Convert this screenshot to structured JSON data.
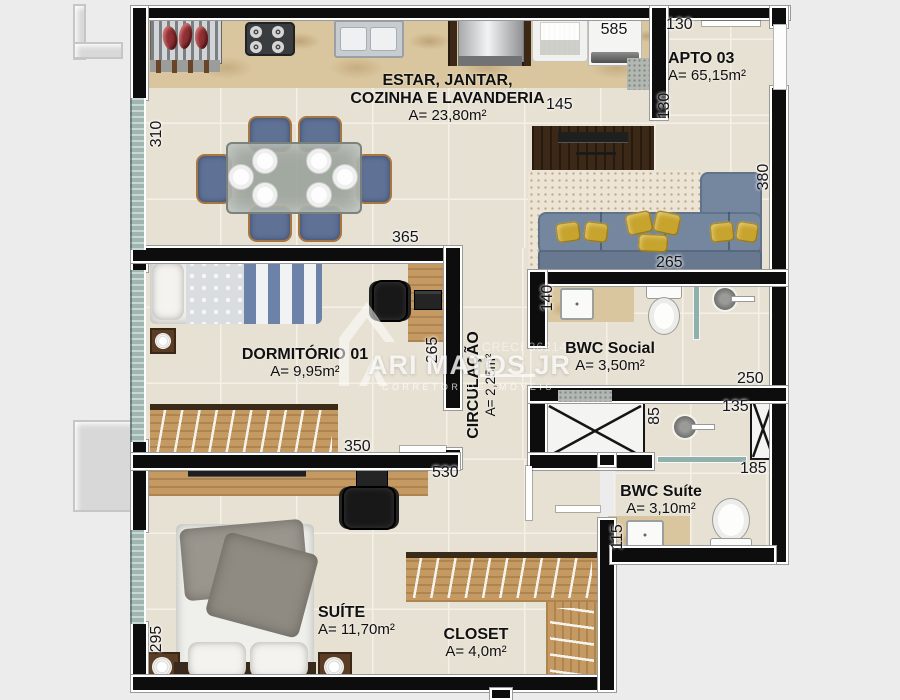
{
  "unit": {
    "name": "APTO 03",
    "area": "A= 65,15m²"
  },
  "rooms": {
    "living": {
      "line1": "ESTAR, JANTAR,",
      "line2": "COZINHA E LAVANDERIA",
      "area": "A= 23,80m²"
    },
    "dorm": {
      "name": "DORMITÓRIO 01",
      "area": "A= 9,95m²"
    },
    "circulacao": {
      "name": "CIRCULAÇÃO",
      "area": "A= 2,25m²"
    },
    "bwc_social": {
      "name": "BWC Social",
      "area": "A= 3,50m²"
    },
    "bwc_suite": {
      "name": "BWC Suíte",
      "area": "A= 3,10m²"
    },
    "suite": {
      "name": "SUÍTE",
      "area": "A= 11,70m²"
    },
    "closet": {
      "name": "CLOSET",
      "area": "A= 4,0m²"
    }
  },
  "dimensions_cm": {
    "entry_hall_width": "130",
    "living_kitchen_width": "585",
    "tv_rack_width": "145",
    "entry_hall_depth": "130",
    "living_window_height": "310",
    "dorm_width": "365",
    "living_depth_right": "380",
    "sofa_length": "265",
    "dorm_depth": "265",
    "bwc_social_counter": "140",
    "bwc_social_width": "250",
    "shaft_height": "85",
    "shower_suite_width": "135",
    "bwc_suite_width": "185",
    "bwc_suite_counter": "115",
    "dorm_wardrobe_width": "350",
    "suite_width": "530",
    "suite_window_height": "295"
  },
  "watermark": {
    "brand": "ARI MATOS JR",
    "tagline": "CORRETOR DE IMÓVEIS",
    "license": "CRECI 36214"
  },
  "icons": {
    "shaft_cross": "utility-shaft-x",
    "door_leaf": "open-door-line",
    "window_band": "window-glass-band",
    "lamp": "round-table-lamp",
    "shower": "shower-head"
  },
  "colors": {
    "background": "#ececec",
    "wall": "#0d0d0d",
    "floor_tile": "#e7e1d3",
    "tile_grout": "#f4f0e7",
    "marble_counter": "#d9c69e",
    "wood_light": "#c59a62",
    "wood_dark": "#3b2817",
    "sofa_blue": "#75869f",
    "chair_blue": "#5f7296",
    "pillow_yellow": "#c7a42e",
    "window_glass": "#9fb5af",
    "rug": "#ece4d4",
    "fixture_white": "#f4f4f2"
  }
}
